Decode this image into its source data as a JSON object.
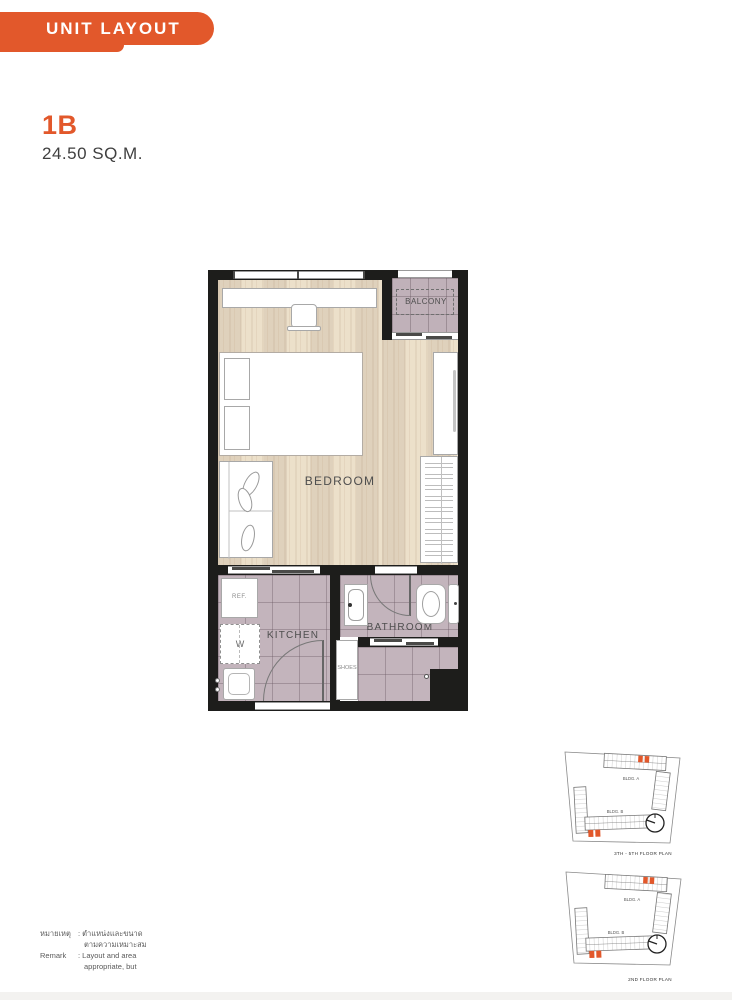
{
  "header": {
    "banner_label": "UNIT LAYOUT"
  },
  "unit": {
    "code": "1B",
    "area": "24.50 SQ.M."
  },
  "floorplan": {
    "labels": {
      "balcony": "BALCONY",
      "bedroom": "BEDROOM",
      "kitchen": "KITCHEN",
      "bathroom": "BATHROOM",
      "shoes": "SHOES",
      "ref": "REF.",
      "washer": "W"
    }
  },
  "site_plans": [
    {
      "bldg_a": "BLDG. A",
      "bldg_b": "BLDG. B",
      "caption": "3TH - 5TH FLOOR PLAN"
    },
    {
      "bldg_a": "BLDG. A",
      "bldg_b": "BLDG. B",
      "caption": "2ND FLOOR PLAN"
    }
  ],
  "remark": {
    "label_th": "หมายเหตุ",
    "text_th1": ": ตำแหน่งและขนาด",
    "text_th2": "ตามความเหมาะสม",
    "label_en": "Remark",
    "text_en1": ": Layout and area",
    "text_en2": "appropriate, but"
  },
  "colors": {
    "accent": "#E2582B",
    "wall": "#1D1D1B",
    "wood": "#E8DBC6",
    "tile": "#C3B4BC"
  }
}
